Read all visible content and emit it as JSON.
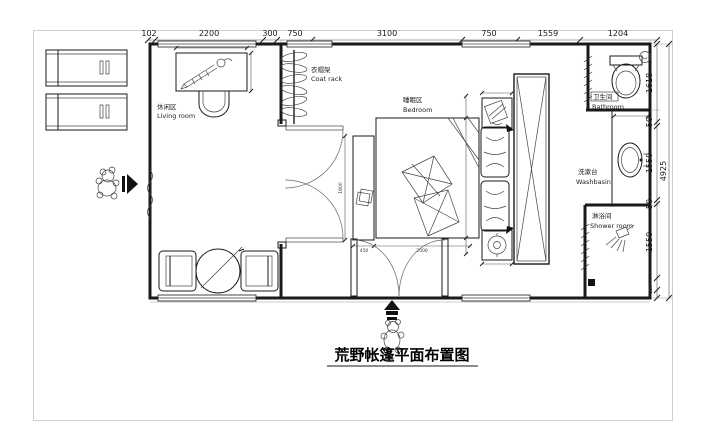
{
  "drawing": {
    "title": "荒野帐篷平面布置图"
  },
  "dims": {
    "top": [
      "102",
      "2200",
      "300",
      "750",
      "3100",
      "750",
      "1559",
      "1204"
    ],
    "right": [
      "1618",
      "50",
      "1550",
      "50",
      "1550",
      "250"
    ],
    "right_total": "4925",
    "bed": {
      "bench_width": "450",
      "bed_width": "2000",
      "bed_length": "1800"
    }
  },
  "rooms": {
    "living": {
      "zh": "休闲区",
      "en": "Living room"
    },
    "coat_rack": {
      "zh": "衣帽架",
      "en": "Coat rack"
    },
    "bedroom": {
      "zh": "睡眠区",
      "en": "Bedroom"
    },
    "bathroom": {
      "zh": "卫生间",
      "en": "Bathroom"
    },
    "washbasin": {
      "zh": "洗漱台",
      "en": "Washbasin"
    },
    "shower": {
      "zh": "淋浴间",
      "en": "Shower room"
    }
  },
  "colors": {
    "line": "#1a1a1a",
    "frame": "#cfcfcf",
    "background": "#ffffff"
  },
  "icons": {
    "bear_icon": "outline-cartoon-bear",
    "arrow_right_icon": "▶",
    "arrow_up_icon": "▲",
    "toilet_icon": "oval-bowl-with-tank",
    "ceiling_light_icon": "circle",
    "washbasin_icon": "oval-basin",
    "shower_head_icon": "head-with-spray-lines",
    "drain_icon": "black-square",
    "coat_hanger_icon": "stacked-hangers-on-pole",
    "pen_icon": "diagonal-pen",
    "lamp_icon": "double-circle",
    "plant_icon": "hatched-square",
    "wardrobe_icon": "rect-with-x-cross"
  }
}
